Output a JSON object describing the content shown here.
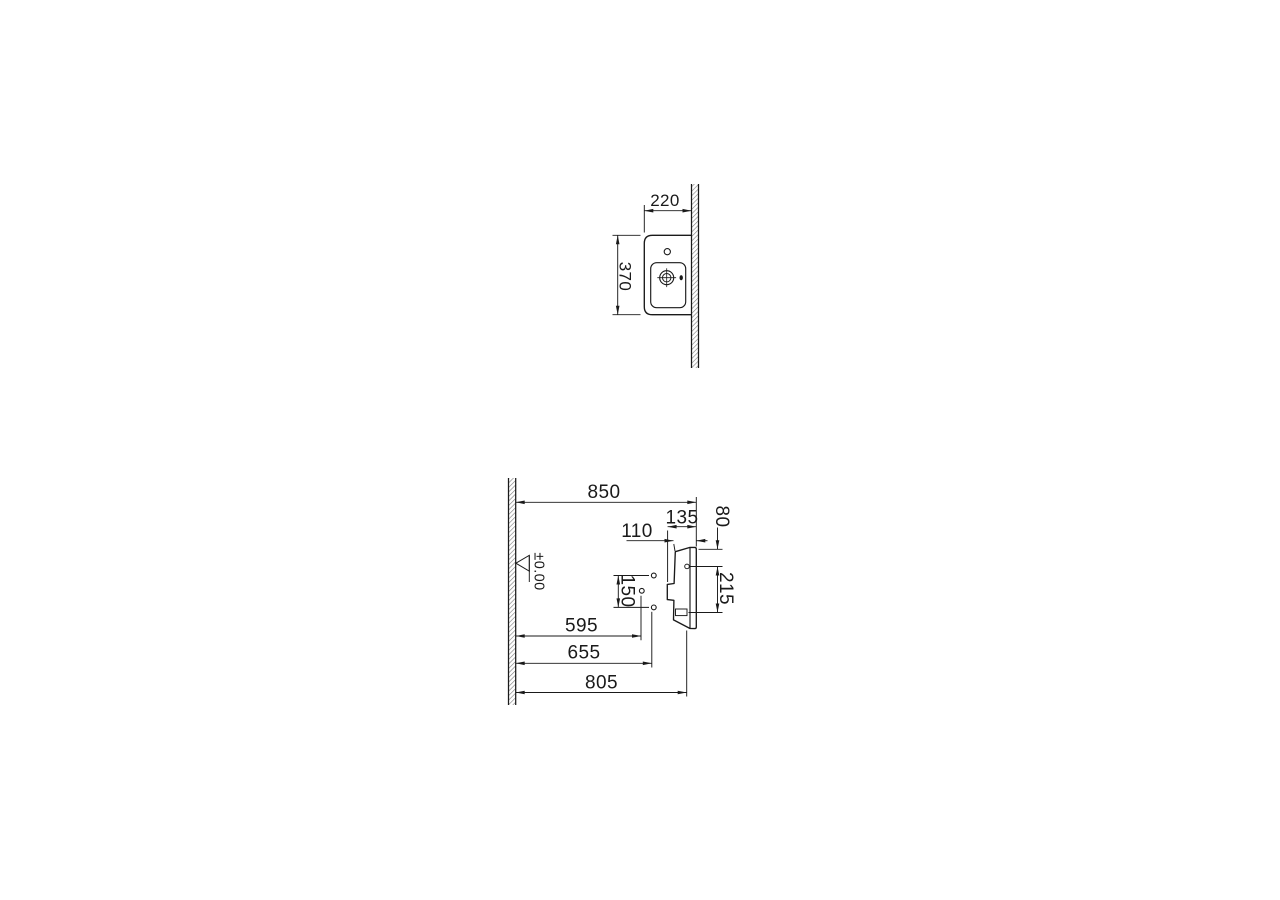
{
  "page": {
    "background": "#ffffff",
    "line_color": "#1a1a1a",
    "hatch_color": "#7d7d7d"
  },
  "plan_view": {
    "width_mm": "220",
    "depth_mm": "370"
  },
  "elevation_view": {
    "rim_height": "850",
    "outlet_depth": "135",
    "tap_offset": "80",
    "basin_depth": "110",
    "tap_to_fixing": "215",
    "hole_spacing": "150",
    "drain_height": "595",
    "supply_height": "655",
    "underside_height": "805",
    "floor_datum": "±0.00"
  }
}
